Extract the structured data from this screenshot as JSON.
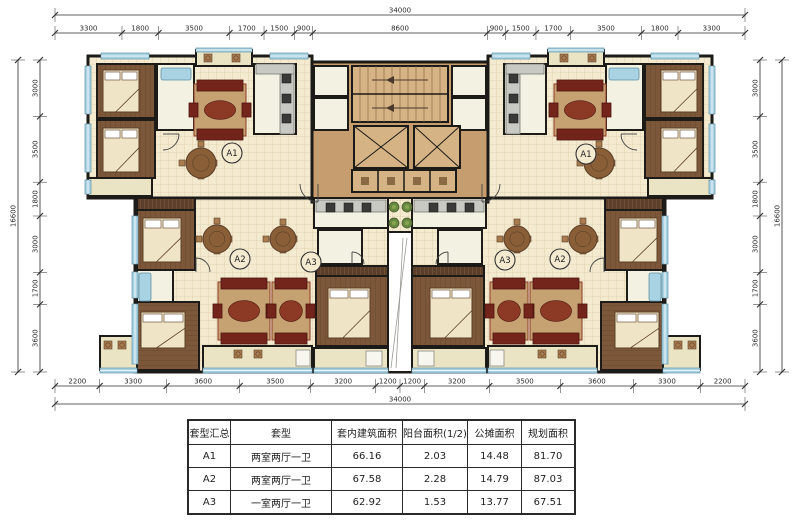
{
  "dimensions": {
    "top": {
      "overall": "34000",
      "segments": [
        3300,
        1800,
        3500,
        1700,
        1500,
        900,
        8600,
        900,
        1500,
        1700,
        3500,
        1800,
        3300
      ]
    },
    "bottom": {
      "overall": "34000",
      "segments": [
        2200,
        3300,
        3600,
        3500,
        3200,
        1200,
        1200,
        3200,
        3500,
        3600,
        3300,
        2200
      ]
    },
    "left": {
      "overall": "16600",
      "segments": [
        3000,
        3500,
        1800,
        3000,
        1700,
        3600
      ]
    },
    "right": {
      "overall": "16600",
      "segments": [
        3000,
        3500,
        1800,
        3000,
        1700,
        3600
      ]
    }
  },
  "unit_labels": [
    {
      "text": "A1",
      "x": 232,
      "y": 153
    },
    {
      "text": "A2",
      "x": 240,
      "y": 259
    },
    {
      "text": "A3",
      "x": 311,
      "y": 262
    },
    {
      "text": "A3",
      "x": 505,
      "y": 260
    },
    {
      "text": "A2",
      "x": 560,
      "y": 259
    },
    {
      "text": "A1",
      "x": 586,
      "y": 154
    }
  ],
  "table": {
    "headers": [
      "套型汇总",
      "套型",
      "套内建筑面积",
      "阳台面积(1/2)",
      "公摊面积",
      "规划面积"
    ],
    "col_widths": [
      41,
      100,
      70,
      64,
      53,
      52
    ],
    "rows": [
      [
        "A1",
        "两室两厅一卫",
        "66.16",
        "2.03",
        "14.48",
        "81.70"
      ],
      [
        "A2",
        "两室两厅一卫",
        "67.58",
        "2.28",
        "14.79",
        "87.03"
      ],
      [
        "A3",
        "一室两厅一卫",
        "62.92",
        "1.53",
        "13.77",
        "67.51"
      ]
    ]
  },
  "colors": {
    "wall": "#1d1b17",
    "dim": "#2b2b2b",
    "tile": "#f3ead0",
    "tile_line": "#d6c298",
    "wood": "#7c573a",
    "wood_line": "#5c3f27",
    "bath": "#f3f1e2",
    "balcony": "#ebe4c4",
    "white": "#ffffff",
    "core": "#c59d6e",
    "core_light": "#d6b385",
    "window": "#a9d2e2",
    "wardrobe": "#5b3f2a",
    "sofa": "#73251b",
    "sofa_dark": "#4d160f",
    "rug": "#c6a171",
    "rug_oval": "#8c3a26",
    "bed": "#efe4c6",
    "counter": "#c9c9c3",
    "appliance": "#3a3a38",
    "dining": "#8a5f38",
    "chair": "#a87c4f",
    "green": "#69883f",
    "box": "#f7f6ef"
  },
  "plan": {
    "zones": [
      [
        88,
        56,
        224,
        142,
        "tile",
        1
      ],
      [
        135,
        198,
        265,
        174,
        "tile",
        1
      ],
      [
        312,
        62,
        176,
        140,
        "core",
        0
      ]
    ],
    "rooms": [
      [
        97,
        64,
        58,
        54,
        "wood",
        1
      ],
      [
        97,
        120,
        58,
        58,
        "wood",
        1
      ],
      [
        88,
        178,
        64,
        18,
        "balcony",
        1
      ],
      [
        157,
        64,
        37,
        66,
        "bath",
        1
      ],
      [
        254,
        64,
        42,
        70,
        "bath",
        1
      ],
      [
        196,
        50,
        56,
        16,
        "balcony",
        1
      ],
      [
        314,
        66,
        34,
        30,
        "bath",
        1
      ],
      [
        314,
        98,
        34,
        32,
        "bath",
        1
      ],
      [
        137,
        198,
        58,
        12,
        "wardrobe",
        1
      ],
      [
        137,
        210,
        58,
        60,
        "wood",
        1
      ],
      [
        137,
        270,
        36,
        32,
        "bath",
        1
      ],
      [
        137,
        302,
        62,
        68,
        "woodH",
        1
      ],
      [
        314,
        198,
        74,
        30,
        "bath",
        1
      ],
      [
        318,
        230,
        44,
        34,
        "bath",
        1
      ],
      [
        316,
        266,
        72,
        10,
        "wardrobe",
        1
      ],
      [
        316,
        276,
        72,
        70,
        "wood",
        1
      ],
      [
        314,
        348,
        74,
        22,
        "balcony",
        1
      ],
      [
        203,
        346,
        109,
        24,
        "balcony",
        1
      ],
      [
        100,
        336,
        37,
        34,
        "balcony",
        1
      ],
      [
        388,
        198,
        24,
        34,
        "tile",
        0
      ],
      [
        388,
        232,
        24,
        140,
        "white",
        0
      ]
    ],
    "windows": [
      [
        101,
        53,
        48,
        6,
        1
      ],
      [
        196,
        48,
        56,
        4,
        1
      ],
      [
        270,
        53,
        38,
        6,
        1
      ],
      [
        85,
        66,
        6,
        48,
        1
      ],
      [
        85,
        124,
        6,
        48,
        1
      ],
      [
        85,
        180,
        6,
        14,
        1
      ],
      [
        132,
        216,
        6,
        48,
        1
      ],
      [
        132,
        272,
        6,
        26,
        1
      ],
      [
        132,
        304,
        6,
        60,
        1
      ],
      [
        100,
        368,
        37,
        5,
        1
      ],
      [
        203,
        368,
        109,
        5,
        1
      ],
      [
        314,
        368,
        74,
        5,
        1
      ]
    ],
    "furniture": {
      "beds": [
        [
          103,
          70,
          36,
          42,
          1
        ],
        [
          103,
          128,
          36,
          44,
          1
        ],
        [
          143,
          218,
          38,
          44,
          1
        ],
        [
          141,
          312,
          44,
          36,
          1
        ],
        [
          328,
          288,
          42,
          50,
          1
        ]
      ],
      "sofas": [
        [
          194,
          84,
          52,
          52,
          1
        ],
        [
          218,
          282,
          52,
          58,
          1
        ],
        [
          272,
          282,
          38,
          58,
          1
        ]
      ],
      "dining": [
        [
          201,
          163,
          15,
          1
        ],
        [
          217,
          239,
          14,
          1
        ],
        [
          283,
          239,
          13,
          1
        ]
      ],
      "tubs": [
        [
          161,
          68,
          30,
          12,
          1
        ],
        [
          139,
          273,
          12,
          28,
          1
        ]
      ],
      "counters": [
        [
          280,
          64,
          14,
          70,
          1
        ],
        [
          256,
          64,
          38,
          10,
          1
        ],
        [
          316,
          200,
          70,
          12,
          1
        ]
      ],
      "appliances": [
        [
          282,
          74,
          1
        ],
        [
          282,
          94,
          1
        ],
        [
          282,
          114,
          1
        ],
        [
          326,
          203,
          1
        ],
        [
          344,
          203,
          1
        ],
        [
          362,
          203,
          1
        ]
      ],
      "chairs": [
        [
          238,
          354,
          1
        ],
        [
          258,
          354,
          1
        ],
        [
          108,
          345,
          1
        ],
        [
          122,
          345,
          1
        ],
        [
          208,
          58,
          1
        ],
        [
          236,
          58,
          1
        ]
      ],
      "boxes": [
        [
          296,
          350,
          14,
          16,
          1
        ],
        [
          366,
          351,
          16,
          15,
          1
        ]
      ],
      "plants": [
        [
          394,
          207,
          0
        ],
        [
          407,
          207,
          0
        ],
        [
          394,
          223,
          0
        ],
        [
          407,
          223,
          0
        ]
      ],
      "stairs": [
        352,
        66,
        96,
        56
      ],
      "elevators": [
        [
          354,
          126,
          54,
          42
        ],
        [
          414,
          126,
          46,
          42
        ]
      ],
      "ducts": [
        352,
        170,
        104,
        22,
        4
      ],
      "arcs": [
        [
          318,
          184,
          18,
          1,
          1
        ],
        [
          352,
          264,
          12,
          3,
          1
        ],
        [
          163,
          134,
          16,
          0,
          1
        ],
        [
          196,
          272,
          14,
          3,
          1
        ]
      ],
      "void_lines": [
        [
          391,
          368,
          407,
          238
        ],
        [
          396,
          368,
          403,
          238
        ]
      ]
    }
  }
}
